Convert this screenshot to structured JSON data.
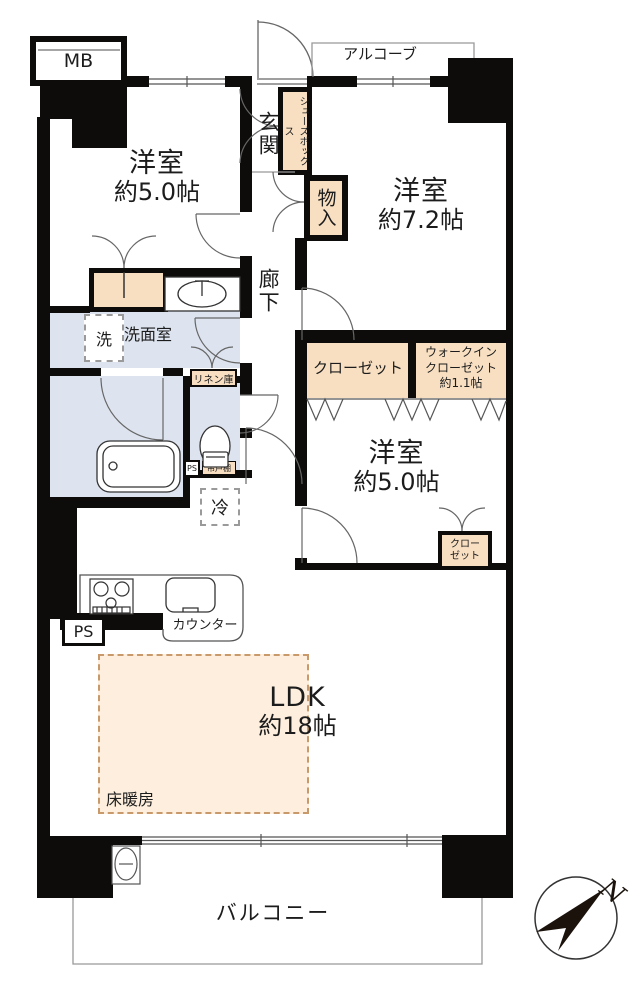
{
  "plan": {
    "mb": "MB",
    "alcove": "アルコーブ",
    "genkan": "玄関",
    "shoes_box": "シューズボックス",
    "storage": "物入",
    "bedroom_a": {
      "name": "洋室",
      "size": "約5.0帖"
    },
    "bedroom_b": {
      "name": "洋室",
      "size": "約7.2帖"
    },
    "bedroom_c": {
      "name": "洋室",
      "size": "約5.0帖"
    },
    "corridor": "廊下",
    "washroom": "洗面室",
    "washer": "洗",
    "linen": "リネン庫",
    "hanging_cabinet": "吊戸棚",
    "ps_toilet": "PS",
    "fridge": "冷",
    "closet": "クローゼット",
    "wic": {
      "line1": "ウォークイン",
      "line2": "クローゼット",
      "line3": "約1.1帖"
    },
    "closet_small": {
      "line1": "クロー",
      "line2": "ゼット"
    },
    "ps_kitchen": "PS",
    "counter": "カウンター",
    "ldk": {
      "name": "LDK",
      "size": "約18帖"
    },
    "floor_heating": "床暖房",
    "balcony": "バルコニー",
    "compass_north": "N"
  },
  "colors": {
    "wall": "#0d0c0b",
    "closet_fill": "#f8dfc2",
    "wet_area_fill": "#dde4ef",
    "floor_heating_fill": "#fdeedd",
    "thin_line": "#666666"
  }
}
